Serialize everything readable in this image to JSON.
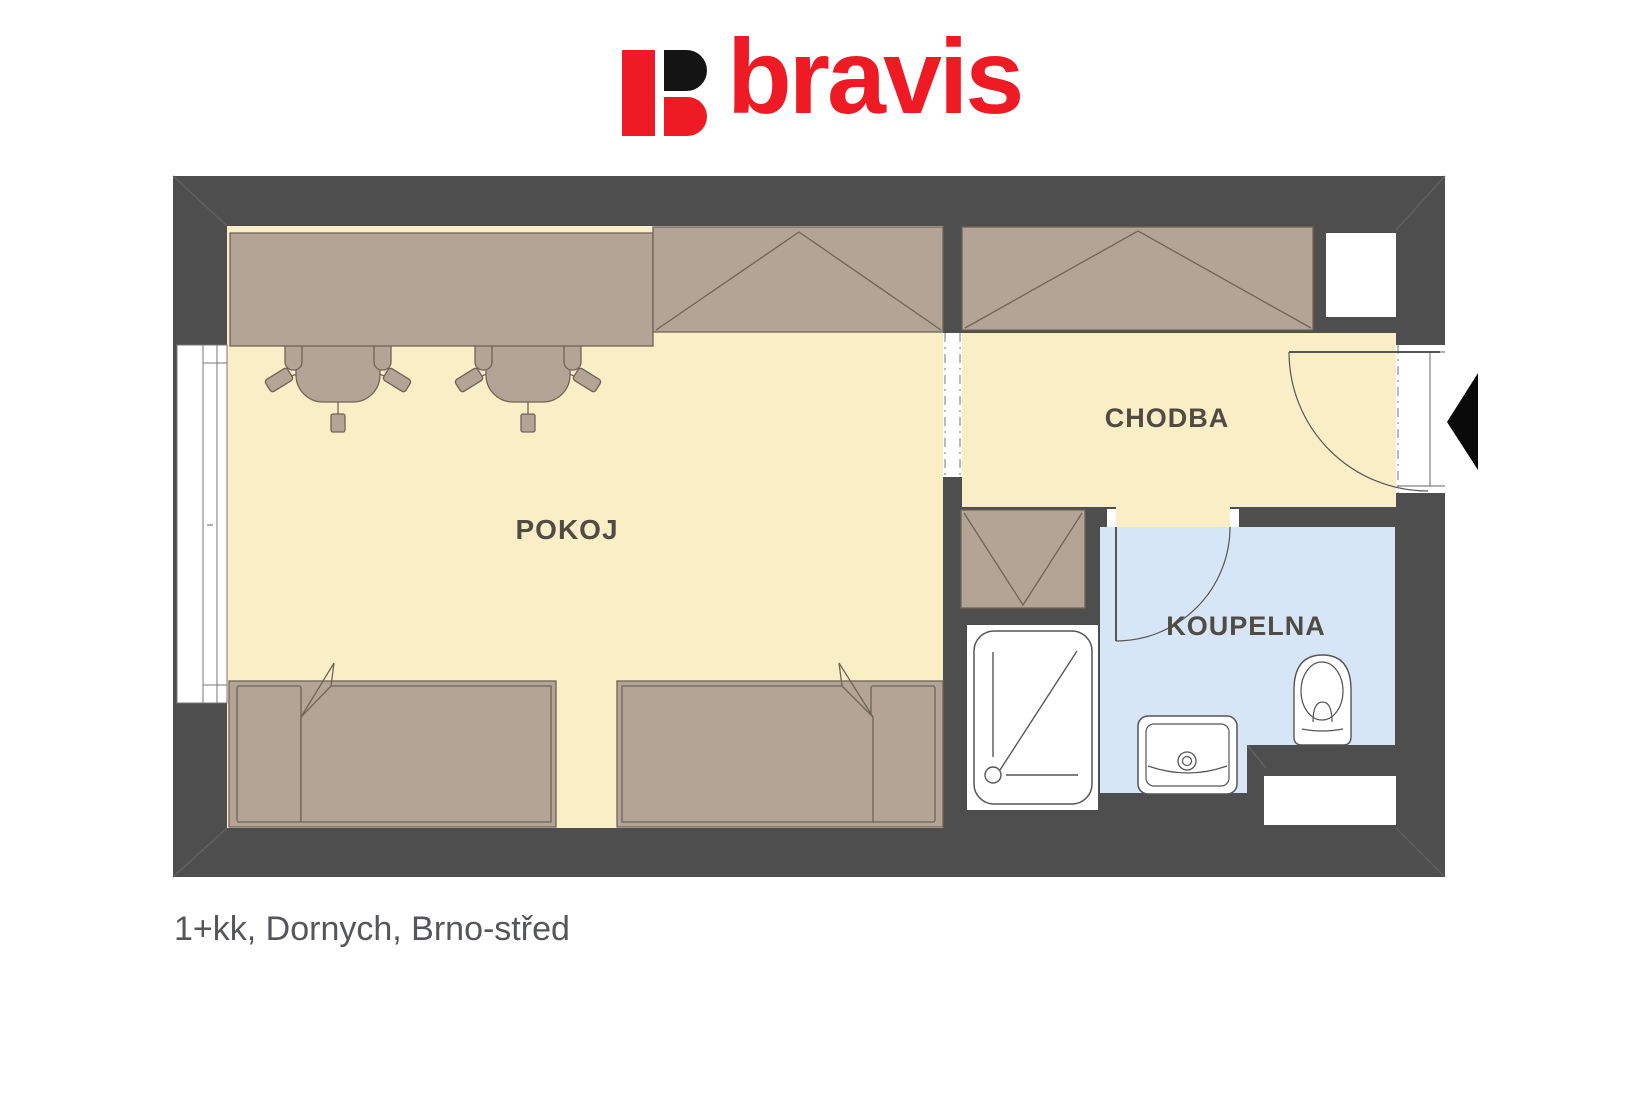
{
  "logo": {
    "text": "bravis",
    "icon": "bravis-b-icon",
    "brand_red": "#ee1b24",
    "brand_black": "#141414"
  },
  "floor_plan": {
    "rooms": [
      {
        "id": "pokoj",
        "label": "POKOJ"
      },
      {
        "id": "chodba",
        "label": "CHODBA"
      },
      {
        "id": "koupelna",
        "label": "KOUPELNA"
      }
    ],
    "furniture": [
      "desk",
      "office-chair",
      "office-chair",
      "wardrobe-pokoj",
      "wardrobe-chodba",
      "utility-closet",
      "bed",
      "bed",
      "shower",
      "washbasin",
      "toilet"
    ],
    "openings": [
      "window-left",
      "passage-pokoj-chodba",
      "entrance-door",
      "bathroom-door"
    ],
    "colors": {
      "wall": "#4e4e4e",
      "floor_room": "#faeec7",
      "floor_bathroom": "#d6e6f6",
      "furniture": "#b3a495",
      "furniture_stroke": "#6f6457",
      "fixture_stroke": "#555555",
      "label_text": "#514c43"
    }
  },
  "caption": "1+kk, Dornych, Brno-střed"
}
